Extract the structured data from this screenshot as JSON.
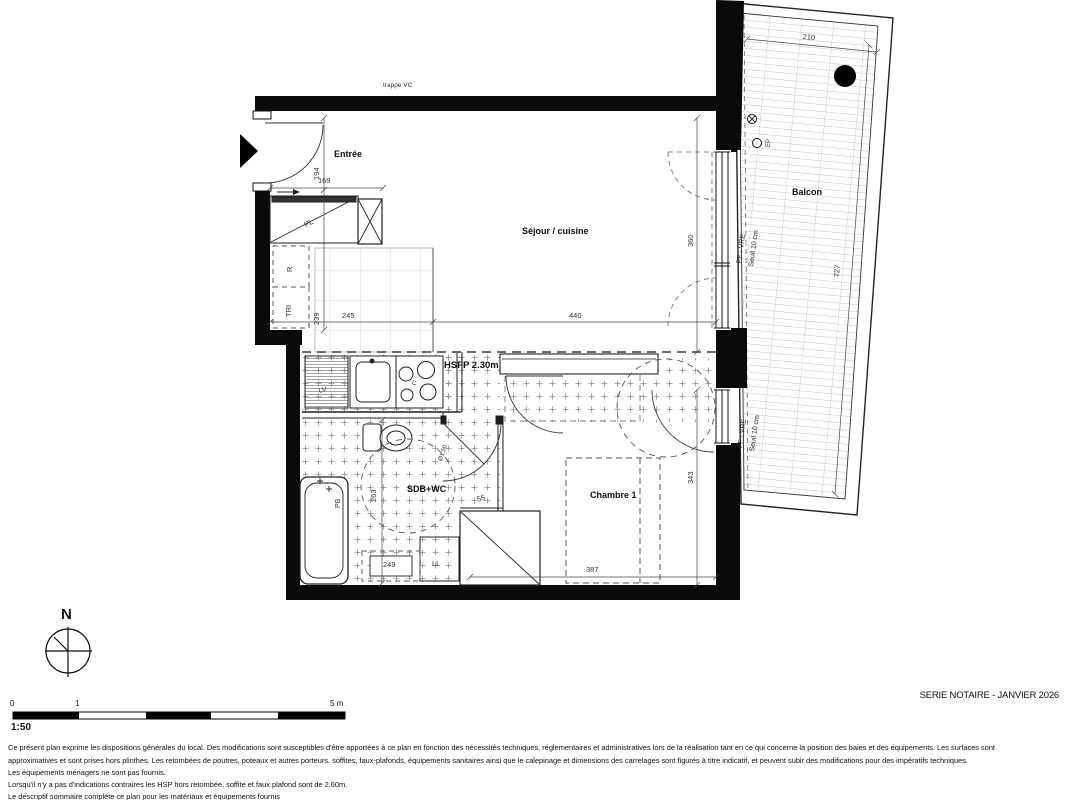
{
  "plan": {
    "rooms": {
      "entree": "Entrée",
      "sejour": "Séjour / cuisine",
      "balcon": "Balcon",
      "sdb": "SDB+WC",
      "chambre": "Chambre 1"
    },
    "annotations": {
      "trappe": "trappe VC",
      "hsfp": "HSFP 2.30m",
      "pl": "PL",
      "r": "R",
      "tri": "TRI",
      "lv": "LV",
      "c": "C",
      "ll": "LL",
      "pb": "PB",
      "ep": "EP",
      "pf_vre": "PF - VRE",
      "seuil": "Seuil 10 cm",
      "diam": "Ø1,50"
    },
    "dims": {
      "d194": "194",
      "d169": "169",
      "d239": "239",
      "d245": "245",
      "d440": "440",
      "d360": "360",
      "d210": "210",
      "d727": "727",
      "d343": "343",
      "d387": "387",
      "d263": "263",
      "d249": "249",
      "d55": "55"
    }
  },
  "compass": {
    "north": "N"
  },
  "scalebar": {
    "zero": "0",
    "one": "1",
    "five": "5 m",
    "ratio": "1:50"
  },
  "footer": {
    "serie": "SERIE NOTAIRE - JANVIER 2026",
    "lines": [
      "Ce présent plan exprime les dispositions générales du local. Des modifications sont susceptibles d'être apportées à ce plan en fonction des nécessités techniques, réglementaires et administratives lors de la réalisation tant en ce qui concerne la position des baies et des équipements. Les surfaces sont",
      "approximatives et sont prises hors plinthes. Les retombées de poutres, poteaux et autres porteurs, soffites, faux-plafonds, équipements sanitaires ainsi que le calepinage et dimensions des carrelages sont figurés à titre indicatif, et peuvent subir des modifications pour des impératifs techniques.",
      "Les équipements ménagers ne sont pas fournis.",
      "Lorsqu'il n'y a pas d'indications contraires les HSP hors retombée, soffite et faux plafond sont de 2,60m.",
      "Le descriptif sommaire complète ce plan pour les matériaux et équipements fournis"
    ]
  }
}
